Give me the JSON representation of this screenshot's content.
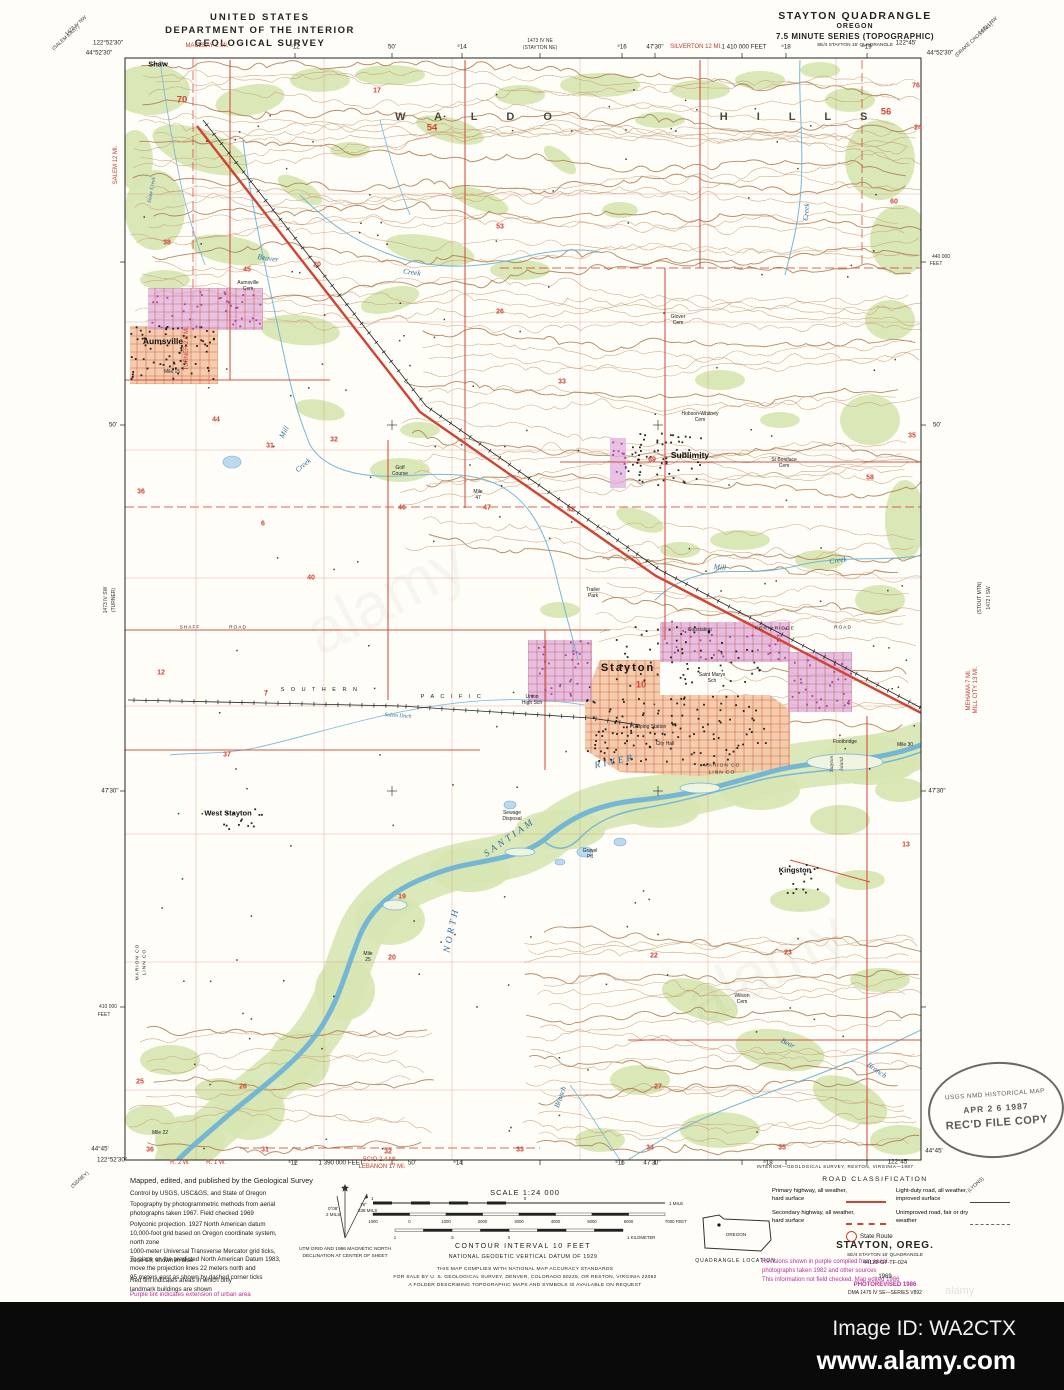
{
  "header": {
    "left1": "UNITED STATES",
    "left2": "DEPARTMENT OF THE INTERIOR",
    "left3": "GEOLOGICAL SURVEY",
    "right1": "STAYTON QUADRANGLE",
    "right2": "OREGON",
    "right3": "7.5 MINUTE SERIES (TOPOGRAPHIC)",
    "right4": "SE/4 STAYTON 15' QUADRANGLE"
  },
  "colors": {
    "contour": "#c79a6f",
    "contour_index": "#ab7a4e",
    "water": "#6fb3d6",
    "water_fill": "#bcd9ee",
    "green": "#d7e6b2",
    "road_red": "#d04434",
    "urban_pink": "#f5c6a4",
    "urban_purple": "#e2b3df",
    "building_purple": "#a13a9b",
    "grid": "#d4795f",
    "street": "#c05a40",
    "black": "#1c1c1c"
  },
  "map": {
    "labels": [
      {
        "t": "W A L D O",
        "x": 480,
        "y": 117,
        "c": "hills"
      },
      {
        "t": "H I L L S",
        "x": 800,
        "y": 117,
        "c": "hills"
      },
      {
        "t": "Shaw",
        "x": 158,
        "y": 64,
        "c": "town-sm"
      },
      {
        "t": "Aumsville",
        "x": 163,
        "y": 341,
        "c": "town"
      },
      {
        "t": "Sublimity",
        "x": 690,
        "y": 455,
        "c": "town"
      },
      {
        "t": "Stayton",
        "x": 628,
        "y": 668,
        "c": "city"
      },
      {
        "t": "West Stayton",
        "x": 228,
        "y": 813,
        "c": "town-sm"
      },
      {
        "t": "Kingston",
        "x": 795,
        "y": 870,
        "c": "town-sm"
      },
      {
        "t": "S O U T H E R N",
        "x": 320,
        "y": 690,
        "c": "rail"
      },
      {
        "t": "P A C I F I C",
        "x": 452,
        "y": 697,
        "c": "rail"
      },
      {
        "t": "Beaver",
        "x": 268,
        "y": 258,
        "c": "water",
        "r": 8
      },
      {
        "t": "Creek",
        "x": 412,
        "y": 272,
        "c": "water",
        "r": 8
      },
      {
        "t": "Shaw Creek",
        "x": 152,
        "y": 190,
        "c": "water-sm",
        "r": -80
      },
      {
        "t": "Mill",
        "x": 284,
        "y": 432,
        "c": "water",
        "r": -62
      },
      {
        "t": "Creek",
        "x": 303,
        "y": 465,
        "c": "water",
        "r": -40
      },
      {
        "t": "Mill",
        "x": 720,
        "y": 567,
        "c": "water",
        "r": 5
      },
      {
        "t": "Creek",
        "x": 838,
        "y": 560,
        "c": "water",
        "r": -8
      },
      {
        "t": "Creek",
        "x": 806,
        "y": 212,
        "c": "water",
        "r": -85
      },
      {
        "t": "SANTIAM",
        "x": 510,
        "y": 838,
        "c": "water-lg",
        "r": -35
      },
      {
        "t": "RIVER",
        "x": 615,
        "y": 762,
        "c": "water-lg",
        "r": -12
      },
      {
        "t": "NORTH",
        "x": 452,
        "y": 930,
        "c": "water-lg",
        "r": -78
      },
      {
        "t": "Salem Ditch",
        "x": 398,
        "y": 716,
        "c": "water-sm",
        "r": 4
      },
      {
        "t": "Bear",
        "x": 788,
        "y": 1043,
        "c": "water",
        "r": 25
      },
      {
        "t": "Branch",
        "x": 877,
        "y": 1070,
        "c": "water",
        "r": 35
      },
      {
        "t": "Branch",
        "x": 560,
        "y": 1097,
        "c": "water",
        "r": -70
      },
      {
        "t": "Stayton",
        "x": 832,
        "y": 764,
        "c": "isl",
        "r": -90
      },
      {
        "t": "Island",
        "x": 842,
        "y": 764,
        "c": "isl",
        "r": -90
      },
      {
        "t": "SHAFF",
        "x": 190,
        "y": 628,
        "c": "tiny-ls"
      },
      {
        "t": "ROAD",
        "x": 238,
        "y": 628,
        "c": "tiny-ls"
      },
      {
        "t": "Substation",
        "x": 700,
        "y": 630,
        "c": "tiny"
      },
      {
        "t": "FERN RIDGE",
        "x": 775,
        "y": 629,
        "c": "tiny-ls"
      },
      {
        "t": "ROAD",
        "x": 843,
        "y": 628,
        "c": "tiny-ls"
      },
      {
        "t": "Trailer",
        "x": 593,
        "y": 590,
        "c": "tiny"
      },
      {
        "t": "Park",
        "x": 593,
        "y": 596,
        "c": "tiny"
      },
      {
        "t": "Golf",
        "x": 400,
        "y": 468,
        "c": "tiny"
      },
      {
        "t": "Course",
        "x": 400,
        "y": 474,
        "c": "tiny"
      },
      {
        "t": "Union",
        "x": 532,
        "y": 697,
        "c": "tiny"
      },
      {
        "t": "High Sch",
        "x": 532,
        "y": 703,
        "c": "tiny"
      },
      {
        "t": "Saint Marys",
        "x": 712,
        "y": 675,
        "c": "tiny"
      },
      {
        "t": "Sch",
        "x": 712,
        "y": 681,
        "c": "tiny"
      },
      {
        "t": "Pumping Station",
        "x": 648,
        "y": 727,
        "c": "tiny"
      },
      {
        "t": "City Hall",
        "x": 665,
        "y": 744,
        "c": "tiny"
      },
      {
        "t": "Sewage",
        "x": 512,
        "y": 813,
        "c": "tiny"
      },
      {
        "t": "Disposal",
        "x": 512,
        "y": 819,
        "c": "tiny"
      },
      {
        "t": "Gravel",
        "x": 590,
        "y": 851,
        "c": "tiny"
      },
      {
        "t": "Pit",
        "x": 590,
        "y": 857,
        "c": "tiny"
      },
      {
        "t": "Footbridge",
        "x": 845,
        "y": 742,
        "c": "tiny"
      },
      {
        "t": "St Boniface",
        "x": 784,
        "y": 460,
        "c": "tiny"
      },
      {
        "t": "Cem",
        "x": 784,
        "y": 466,
        "c": "tiny"
      },
      {
        "t": "Glover",
        "x": 678,
        "y": 317,
        "c": "tiny"
      },
      {
        "t": "Cem",
        "x": 678,
        "y": 323,
        "c": "tiny"
      },
      {
        "t": "Aumsville",
        "x": 248,
        "y": 283,
        "c": "tiny"
      },
      {
        "t": "Cem",
        "x": 248,
        "y": 289,
        "c": "tiny"
      },
      {
        "t": "Hobson-Whitney",
        "x": 700,
        "y": 414,
        "c": "tiny"
      },
      {
        "t": "Cem",
        "x": 700,
        "y": 420,
        "c": "tiny"
      },
      {
        "t": "Wilson",
        "x": 742,
        "y": 996,
        "c": "tiny"
      },
      {
        "t": "Cem",
        "x": 742,
        "y": 1002,
        "c": "tiny"
      },
      {
        "t": "Mile 15",
        "x": 172,
        "y": 372,
        "c": "tiny"
      },
      {
        "t": "Mile",
        "x": 478,
        "y": 492,
        "c": "tiny"
      },
      {
        "t": "47",
        "x": 478,
        "y": 498,
        "c": "tiny"
      },
      {
        "t": "Mile",
        "x": 368,
        "y": 954,
        "c": "tiny"
      },
      {
        "t": "25",
        "x": 368,
        "y": 960,
        "c": "tiny"
      },
      {
        "t": "Mile 22",
        "x": 160,
        "y": 1133,
        "c": "tiny"
      },
      {
        "t": "Mile 30",
        "x": 905,
        "y": 745,
        "c": "tiny"
      },
      {
        "t": "MARION CO",
        "x": 722,
        "y": 766,
        "c": "tiny-ls"
      },
      {
        "t": "LINN CO",
        "x": 722,
        "y": 773,
        "c": "tiny-ls"
      },
      {
        "t": "MARION CO",
        "x": 138,
        "y": 962,
        "c": "tiny-ls",
        "r": -90
      },
      {
        "t": "LINN CO",
        "x": 145,
        "y": 962,
        "c": "tiny-ls",
        "r": -90
      },
      {
        "t": "122°52'30\"",
        "x": 108,
        "y": 43,
        "c": "m"
      },
      {
        "t": "44°52'30\"",
        "x": 99,
        "y": 53,
        "c": "m"
      },
      {
        "t": "MACLEAY 2 MI.",
        "x": 207,
        "y": 46,
        "c": "m-red"
      },
      {
        "t": "⁵12",
        "x": 295,
        "y": 47,
        "c": "m"
      },
      {
        "t": "50'",
        "x": 392,
        "y": 47,
        "c": "m"
      },
      {
        "t": "⁵14",
        "x": 462,
        "y": 47,
        "c": "m"
      },
      {
        "t": "1473 IV NE",
        "x": 540,
        "y": 41,
        "c": "m-sm"
      },
      {
        "t": "(STAYTON NE)",
        "x": 540,
        "y": 48,
        "c": "m-sm"
      },
      {
        "t": "⁵16",
        "x": 622,
        "y": 47,
        "c": "m"
      },
      {
        "t": "47'30\"",
        "x": 655,
        "y": 47,
        "c": "m"
      },
      {
        "t": "SILVERTON 12 MI.",
        "x": 696,
        "y": 47,
        "c": "m-red"
      },
      {
        "t": "1 410 000 FEET",
        "x": 744,
        "y": 47,
        "c": "m"
      },
      {
        "t": "⁵18",
        "x": 786,
        "y": 47,
        "c": "m"
      },
      {
        "t": "⁵19",
        "x": 867,
        "y": 47,
        "c": "m"
      },
      {
        "t": "122°45'",
        "x": 906,
        "y": 43,
        "c": "m"
      },
      {
        "t": "44°52'30\"",
        "x": 940,
        "y": 53,
        "c": "m"
      },
      {
        "t": "1473 IV NW",
        "x": 76,
        "y": 26,
        "c": "m-sm",
        "r": -42
      },
      {
        "t": "(SALEM EAST)",
        "x": 66,
        "y": 38,
        "c": "m-sm",
        "r": -42
      },
      {
        "t": "1472 I NW",
        "x": 988,
        "y": 26,
        "c": "m-sm",
        "r": -42
      },
      {
        "t": "(DRAKE CROSSING)",
        "x": 974,
        "y": 40,
        "c": "m-sm",
        "r": -42
      },
      {
        "t": "440 000",
        "x": 941,
        "y": 257,
        "c": "m-sm"
      },
      {
        "t": "FEET",
        "x": 936,
        "y": 264,
        "c": "m-sm"
      },
      {
        "t": "50'",
        "x": 937,
        "y": 425,
        "c": "m"
      },
      {
        "t": "1472 I SW",
        "x": 989,
        "y": 598,
        "c": "m-sm",
        "r": -90
      },
      {
        "t": "(STOUT MTN)",
        "x": 980,
        "y": 598,
        "c": "m-sm",
        "r": -90
      },
      {
        "t": "MEHAMA 7 MI.",
        "x": 969,
        "y": 690,
        "c": "m-red",
        "r": -90
      },
      {
        "t": "MILL CITY 13 MI.",
        "x": 976,
        "y": 690,
        "c": "m-red",
        "r": -90
      },
      {
        "t": "47'30\"",
        "x": 937,
        "y": 791,
        "c": "m"
      },
      {
        "t": "(LYONS)",
        "x": 976,
        "y": 1185,
        "c": "m-sm",
        "r": -42
      },
      {
        "t": "44°45'",
        "x": 100,
        "y": 1149,
        "c": "m"
      },
      {
        "t": "122°52'30\"",
        "x": 112,
        "y": 1160,
        "c": "m"
      },
      {
        "t": "R. 2 W.",
        "x": 180,
        "y": 1163,
        "c": "m-red"
      },
      {
        "t": "R. 1 W.",
        "x": 216,
        "y": 1163,
        "c": "m-red"
      },
      {
        "t": "⁵12",
        "x": 293,
        "y": 1163,
        "c": "m"
      },
      {
        "t": "1 390 000 FEET",
        "x": 341,
        "y": 1163,
        "c": "m"
      },
      {
        "t": "SCIO 2.4 MI.",
        "x": 380,
        "y": 1160,
        "c": "m-red"
      },
      {
        "t": "LEBANON 17 MI.",
        "x": 382,
        "y": 1167,
        "c": "m-red"
      },
      {
        "t": "50'",
        "x": 412,
        "y": 1163,
        "c": "m"
      },
      {
        "t": "⁵14",
        "x": 458,
        "y": 1163,
        "c": "m"
      },
      {
        "t": "⁵16",
        "x": 620,
        "y": 1163,
        "c": "m"
      },
      {
        "t": "47'30\"",
        "x": 652,
        "y": 1163,
        "c": "m"
      },
      {
        "t": "⁵18",
        "x": 768,
        "y": 1163,
        "c": "m"
      },
      {
        "t": "122°45'",
        "x": 898,
        "y": 1162,
        "c": "m"
      },
      {
        "t": "44°45'",
        "x": 934,
        "y": 1151,
        "c": "m"
      },
      {
        "t": "(SIDNEY)",
        "x": 80,
        "y": 1180,
        "c": "m-sm",
        "r": -42
      },
      {
        "t": "SALEM 12 MI.",
        "x": 116,
        "y": 165,
        "c": "m-red",
        "r": -90
      },
      {
        "t": "TURNER 2.9 MI.",
        "x": 187,
        "y": 348,
        "c": "m-red",
        "r": -90
      },
      {
        "t": "50'",
        "x": 113,
        "y": 425,
        "c": "m"
      },
      {
        "t": "1473 IV SW",
        "x": 106,
        "y": 600,
        "c": "m-sm",
        "r": -90
      },
      {
        "t": "(TURNER)",
        "x": 114,
        "y": 600,
        "c": "m-sm",
        "r": -90
      },
      {
        "t": "47'30\"",
        "x": 110,
        "y": 791,
        "c": "m"
      },
      {
        "t": "410 000",
        "x": 108,
        "y": 1007,
        "c": "m-sm"
      },
      {
        "t": "FEET",
        "x": 104,
        "y": 1015,
        "c": "m-sm"
      }
    ],
    "sections": [
      [
        70,
        182,
        100,
        1
      ],
      [
        54,
        432,
        128,
        1
      ],
      [
        56,
        886,
        112,
        1
      ],
      [
        76,
        916,
        86,
        0
      ],
      [
        24,
        918,
        128,
        0
      ],
      [
        60,
        894,
        202,
        0
      ],
      [
        17,
        377,
        91,
        0
      ],
      [
        53,
        500,
        227,
        0
      ],
      [
        38,
        167,
        243,
        0
      ],
      [
        45,
        247,
        270,
        0
      ],
      [
        20,
        317,
        265,
        0
      ],
      [
        26,
        500,
        312,
        0
      ],
      [
        33,
        562,
        382,
        0
      ],
      [
        35,
        912,
        436,
        0
      ],
      [
        69,
        652,
        460,
        0
      ],
      [
        58,
        870,
        478,
        0
      ],
      [
        44,
        216,
        420,
        0
      ],
      [
        31,
        270,
        446,
        0
      ],
      [
        32,
        334,
        440,
        0
      ],
      [
        36,
        141,
        492,
        0
      ],
      [
        46,
        402,
        508,
        0
      ],
      [
        47,
        487,
        508,
        0
      ],
      [
        42,
        571,
        510,
        0
      ],
      [
        40,
        311,
        578,
        0
      ],
      [
        6,
        263,
        524,
        0
      ],
      [
        12,
        161,
        673,
        0
      ],
      [
        7,
        266,
        694,
        0
      ],
      [
        37,
        227,
        755,
        0
      ],
      [
        10,
        641,
        685,
        1
      ],
      [
        19,
        402,
        897,
        0
      ],
      [
        20,
        392,
        958,
        0
      ],
      [
        22,
        654,
        956,
        0
      ],
      [
        23,
        788,
        953,
        0
      ],
      [
        13,
        906,
        845,
        0
      ],
      [
        25,
        140,
        1082,
        0
      ],
      [
        26,
        243,
        1087,
        0
      ],
      [
        27,
        658,
        1087,
        0
      ],
      [
        36,
        150,
        1150,
        0
      ],
      [
        31,
        265,
        1150,
        0
      ],
      [
        32,
        388,
        1152,
        0
      ],
      [
        33,
        520,
        1150,
        0
      ],
      [
        34,
        650,
        1148,
        0
      ],
      [
        35,
        782,
        1148,
        0
      ]
    ]
  },
  "collar": {
    "note_mapped": "Mapped, edited, and published by the Geological Survey",
    "note_control": "Control by USGS, USC&GS, and State of Oregon",
    "note_topo": "Topography by photogrammetric methods from aerial\nphotographs taken 1967.  Field checked 1969",
    "note_proj": "Polyconic projection.  1927 North American datum\n10,000-foot grid based on Oregon coordinate system,\nnorth zone\n1000-meter Universal Transverse Mercator grid ticks,\nzone 10, shown in blue",
    "note_nad": "To place on the predicted North American Datum 1983,\nmove the projection lines 22 meters north and\n95 meters east as shown by dashed corner ticks",
    "note_red": "Red tint indicates areas in which only\nlandmark buildings are shown",
    "note_purple": "Purple tint indicates extension of urban area",
    "declination": {
      "cap1": "UTM GRID AND 1986 MAGNETIC NORTH",
      "cap2": "DECLINATION AT CENTER OF SHEET",
      "gn_deg": "0°08'",
      "gn_mils": "2 MILS",
      "mn_deg": "19°",
      "mn_mils": "338 MILS"
    },
    "scale": {
      "label": "SCALE 1:24 000",
      "mile_left": "1",
      "mile_mid": "0",
      "mile_right": "1 MILE",
      "feet_ticks": [
        "1000",
        "0",
        "1000",
        "2000",
        "3000",
        "4000",
        "5000",
        "6000",
        "7000 FEET"
      ],
      "km_ticks": [
        "1",
        ".5",
        "0",
        "1 KILOMETER"
      ],
      "contour": "CONTOUR INTERVAL 10 FEET",
      "datum": "NATIONAL GEODETIC VERTICAL DATUM OF 1929"
    },
    "compliance": "THIS MAP COMPLIES WITH NATIONAL MAP ACCURACY STANDARDS\nFOR SALE BY U. S. GEOLOGICAL SURVEY, DENVER, COLORADO 80225, OR RESTON, VIRGINIA 22092\nA FOLDER DESCRIBING TOPOGRAPHIC MAPS AND SYMBOLS IS AVAILABLE ON REQUEST",
    "quad_loc": {
      "caption": "QUADRANGLE LOCATION",
      "state": "OREGON"
    },
    "revision": "Revisions shown in purple compiled from aerial\nphotographs taken 1982 and other sources\nThis information not field checked.  Map edited 1986",
    "roadclass": {
      "title": "ROAD CLASSIFICATION",
      "p1": "Primary highway, all weather,\nhard surface",
      "p2": "Light-duty road, all weather,\nimproved surface",
      "p3": "Secondary highway, all weather,\nhard surface",
      "p4": "Unimproved road, fair or dry\nweather",
      "sr": "State Route"
    },
    "titleblock": {
      "name": "STAYTON, OREG.",
      "sub": "SE/4 STAYTON 15' QUADRANGLE",
      "code": "44122-G7-TF-024",
      "year": "1969",
      "photorev": "PHOTOREVISED 1986",
      "dma": "DMA 1475 IV SE—SERIES V892"
    },
    "credit": "INTERIOR—GEOLOGICAL SURVEY, RESTON, VIRGINIA—1987"
  },
  "stamp": {
    "l1": "USGS NMD HISTORICAL MAP",
    "l2": "APR 2 6 1987",
    "l3": "REC'D FILE COPY"
  },
  "watermark": {
    "image_id": "Image ID: WA2CTX",
    "url": "www.alamy.com",
    "ghost": "alamy"
  }
}
